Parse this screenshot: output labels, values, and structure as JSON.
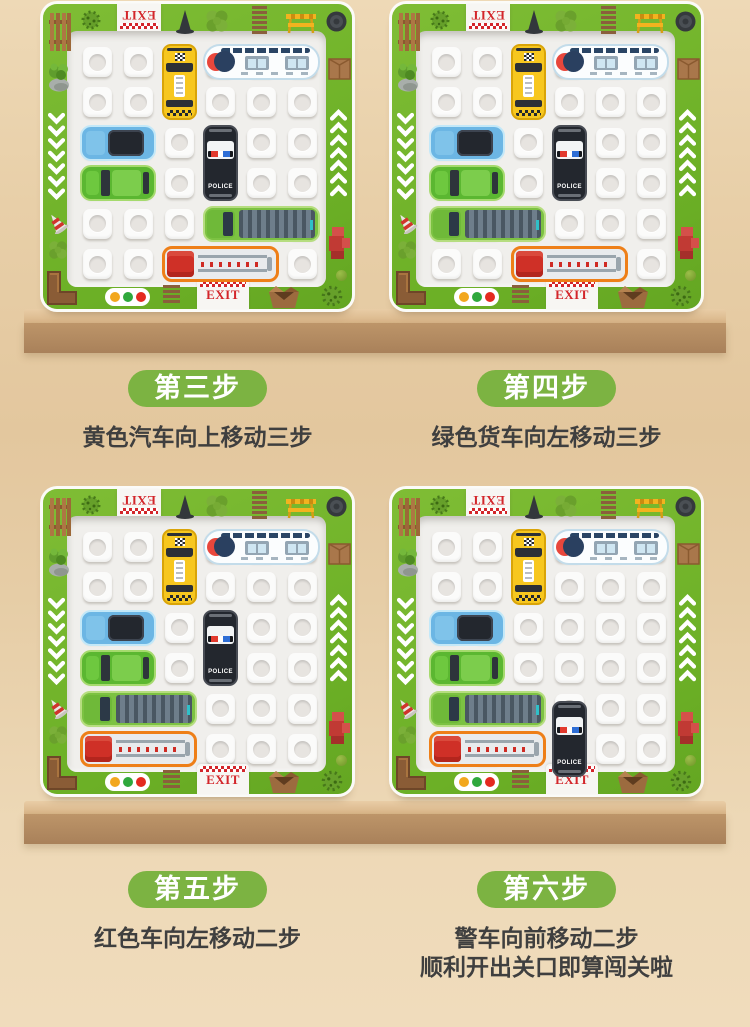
{
  "steps": [
    {
      "badge": "第三步",
      "lines": [
        "黄色汽车向上移动三步"
      ]
    },
    {
      "badge": "第四步",
      "lines": [
        "绿色货车向左移动三步"
      ]
    },
    {
      "badge": "第五步",
      "lines": [
        "红色车向左移动二步"
      ]
    },
    {
      "badge": "第六步",
      "lines": [
        "警车向前移动二步",
        "顺利开出关口即算闯关啦"
      ]
    }
  ],
  "board_chrome": {
    "exit_top_label": "EXIT",
    "exit_bottom_label": "EXIT",
    "police_label": "POLICE",
    "traffic_light_colors": [
      "#f2a71d",
      "#2fa83c",
      "#e42a1f"
    ],
    "decorations": [
      {
        "name": "wood-fence",
        "x": 6,
        "y": 7,
        "w": 22,
        "h": 42
      },
      {
        "name": "spiky-bush",
        "x": 36,
        "y": 4,
        "w": 24,
        "h": 24
      },
      {
        "name": "traffic-cone",
        "x": 132,
        "y": 5,
        "w": 20,
        "h": 25
      },
      {
        "name": "clover",
        "x": 162,
        "y": 5,
        "w": 24,
        "h": 24
      },
      {
        "name": "track-ladder",
        "x": 209,
        "y": 2,
        "w": 15,
        "h": 30
      },
      {
        "name": "barrier",
        "x": 242,
        "y": 7,
        "w": 32,
        "h": 23
      },
      {
        "name": "manhole",
        "x": 283,
        "y": 7,
        "w": 21,
        "h": 21
      },
      {
        "name": "plant-rock",
        "x": 4,
        "y": 56,
        "w": 24,
        "h": 32
      },
      {
        "name": "chevrons-down",
        "x": 5,
        "y": 108,
        "w": 17,
        "h": 92
      },
      {
        "name": "tilted-cone",
        "x": 2,
        "y": 208,
        "w": 24,
        "h": 22
      },
      {
        "name": "clover",
        "x": 5,
        "y": 236,
        "w": 20,
        "h": 20
      },
      {
        "name": "wood-corner",
        "x": 3,
        "y": 266,
        "w": 32,
        "h": 36
      },
      {
        "name": "cardboard-box",
        "x": 285,
        "y": 50,
        "w": 23,
        "h": 26
      },
      {
        "name": "chevrons-up",
        "x": 287,
        "y": 105,
        "w": 17,
        "h": 92
      },
      {
        "name": "hydrant",
        "x": 283,
        "y": 220,
        "w": 25,
        "h": 36
      },
      {
        "name": "traffic-light",
        "x": 62,
        "y": 284,
        "w": 45,
        "h": 18
      },
      {
        "name": "track-ladder",
        "x": 120,
        "y": 281,
        "w": 17,
        "h": 23
      },
      {
        "name": "open-box",
        "x": 222,
        "y": 280,
        "w": 38,
        "h": 25
      },
      {
        "name": "green-ball",
        "x": 293,
        "y": 266,
        "w": 11,
        "h": 11
      },
      {
        "name": "spiky-bush",
        "x": 276,
        "y": 279,
        "w": 26,
        "h": 26
      }
    ]
  },
  "boards": [
    {
      "name": "board-step-3",
      "vehicles": [
        {
          "type": "taxi",
          "row": 0,
          "col": 2,
          "orient": "v",
          "len": 2
        },
        {
          "type": "train",
          "row": 0,
          "col": 3,
          "orient": "h",
          "len": 3
        },
        {
          "type": "blue-car",
          "row": 2,
          "col": 0,
          "orient": "h",
          "len": 2
        },
        {
          "type": "police",
          "row": 2,
          "col": 3,
          "orient": "v",
          "len": 2
        },
        {
          "type": "green-car",
          "row": 3,
          "col": 0,
          "orient": "h",
          "len": 2
        },
        {
          "type": "truck",
          "row": 4,
          "col": 3,
          "orient": "h",
          "len": 3
        },
        {
          "type": "fire-truck",
          "row": 5,
          "col": 2,
          "orient": "h",
          "len": 3
        }
      ]
    },
    {
      "name": "board-step-4",
      "vehicles": [
        {
          "type": "taxi",
          "row": 0,
          "col": 2,
          "orient": "v",
          "len": 2
        },
        {
          "type": "train",
          "row": 0,
          "col": 3,
          "orient": "h",
          "len": 3
        },
        {
          "type": "blue-car",
          "row": 2,
          "col": 0,
          "orient": "h",
          "len": 2
        },
        {
          "type": "police",
          "row": 2,
          "col": 3,
          "orient": "v",
          "len": 2
        },
        {
          "type": "green-car",
          "row": 3,
          "col": 0,
          "orient": "h",
          "len": 2
        },
        {
          "type": "truck",
          "row": 4,
          "col": 0,
          "orient": "h",
          "len": 3
        },
        {
          "type": "fire-truck",
          "row": 5,
          "col": 2,
          "orient": "h",
          "len": 3
        }
      ]
    },
    {
      "name": "board-step-5",
      "vehicles": [
        {
          "type": "taxi",
          "row": 0,
          "col": 2,
          "orient": "v",
          "len": 2
        },
        {
          "type": "train",
          "row": 0,
          "col": 3,
          "orient": "h",
          "len": 3
        },
        {
          "type": "blue-car",
          "row": 2,
          "col": 0,
          "orient": "h",
          "len": 2
        },
        {
          "type": "police",
          "row": 2,
          "col": 3,
          "orient": "v",
          "len": 2
        },
        {
          "type": "green-car",
          "row": 3,
          "col": 0,
          "orient": "h",
          "len": 2
        },
        {
          "type": "truck",
          "row": 4,
          "col": 0,
          "orient": "h",
          "len": 3
        },
        {
          "type": "fire-truck",
          "row": 5,
          "col": 0,
          "orient": "h",
          "len": 3
        }
      ]
    },
    {
      "name": "board-step-6",
      "vehicles": [
        {
          "type": "taxi",
          "row": 0,
          "col": 2,
          "orient": "v",
          "len": 2
        },
        {
          "type": "train",
          "row": 0,
          "col": 3,
          "orient": "h",
          "len": 3
        },
        {
          "type": "blue-car",
          "row": 2,
          "col": 0,
          "orient": "h",
          "len": 2
        },
        {
          "type": "green-car",
          "row": 3,
          "col": 0,
          "orient": "h",
          "len": 2
        },
        {
          "type": "truck",
          "row": 4,
          "col": 0,
          "orient": "h",
          "len": 3
        },
        {
          "type": "fire-truck",
          "row": 5,
          "col": 0,
          "orient": "h",
          "len": 3
        },
        {
          "type": "police",
          "row": 4,
          "col": 3,
          "orient": "v",
          "len": 2,
          "dy": 10
        }
      ]
    }
  ],
  "colors": {
    "badge_green": "#7cb342",
    "frame_green": "#6cb026",
    "exit_red": "#d3262b",
    "text_dark": "#3f3f3f",
    "shelf_top": "#d8b487",
    "shelf_front": "#a9815a",
    "background_beige": "#e6cda6"
  }
}
